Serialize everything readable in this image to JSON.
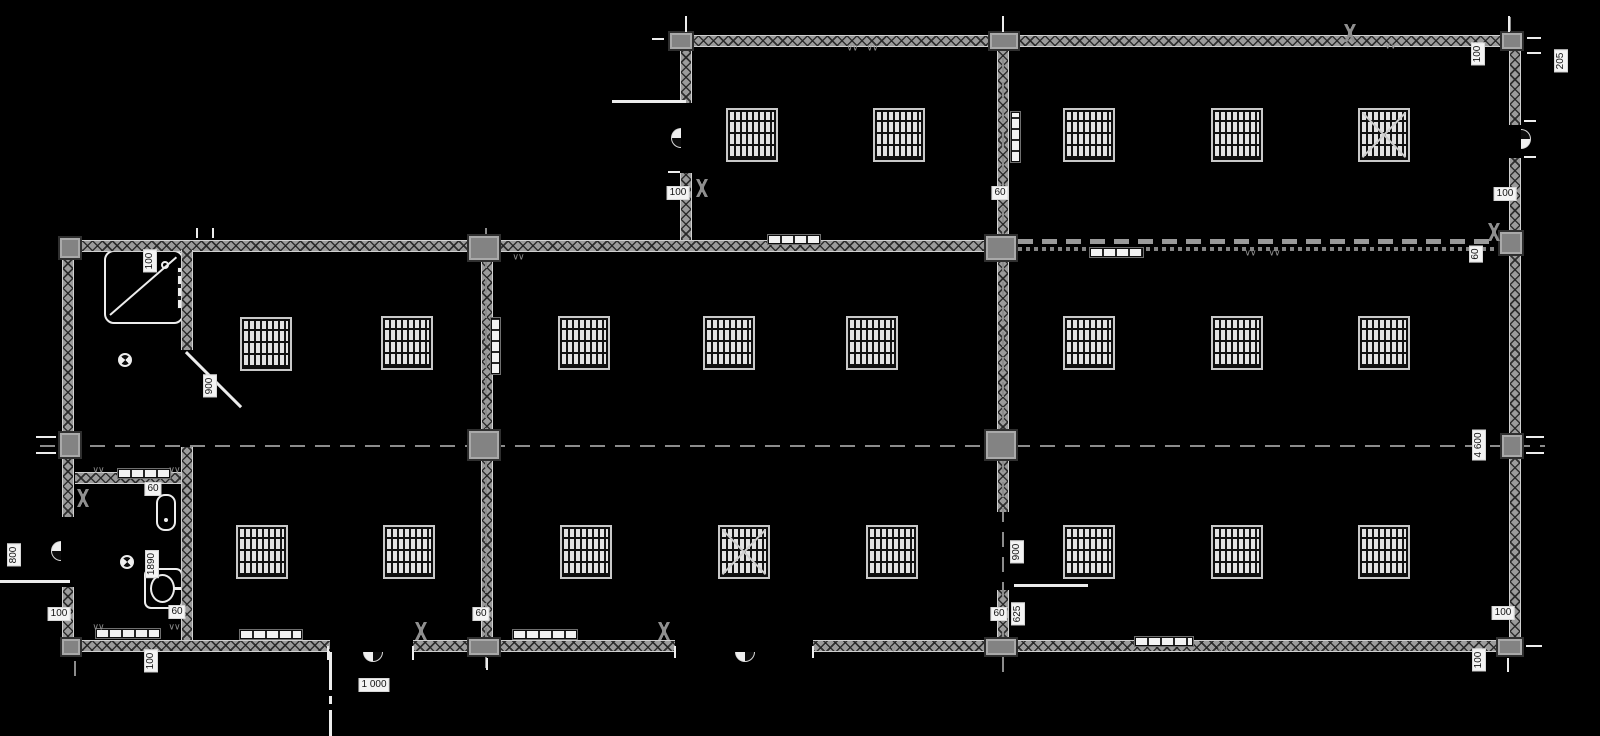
{
  "drawing": {
    "type": "floor_plan",
    "background": "#000000",
    "wall_color": "#9b9b9b",
    "hatch_color": "#2f2f2f",
    "annotation_color": "#f4f4f4",
    "glyphs": {
      "squiggle": "∨∨"
    },
    "labels": [
      {
        "t": "100",
        "x": 678,
        "y": 193,
        "r": 0
      },
      {
        "t": "60",
        "x": 1000,
        "y": 193,
        "r": 0
      },
      {
        "t": "100",
        "x": 1505,
        "y": 194,
        "r": 0
      },
      {
        "t": "100",
        "x": 1478,
        "y": 54,
        "r": 90
      },
      {
        "t": "205",
        "x": 1561,
        "y": 61,
        "r": 90
      },
      {
        "t": "100",
        "x": 150,
        "y": 261,
        "r": 90
      },
      {
        "t": "900",
        "x": 210,
        "y": 386,
        "r": 90
      },
      {
        "t": "800",
        "x": 14,
        "y": 555,
        "r": 90
      },
      {
        "t": "100",
        "x": 59,
        "y": 614,
        "r": 0
      },
      {
        "t": "60",
        "x": 153,
        "y": 489,
        "r": 0
      },
      {
        "t": "1890",
        "x": 152,
        "y": 564,
        "r": 90
      },
      {
        "t": "60",
        "x": 177,
        "y": 612,
        "r": 0
      },
      {
        "t": "100",
        "x": 151,
        "y": 661,
        "r": 90
      },
      {
        "t": "1 000",
        "x": 374,
        "y": 685,
        "r": 0
      },
      {
        "t": "60",
        "x": 481,
        "y": 614,
        "r": 0
      },
      {
        "t": "900",
        "x": 1017,
        "y": 552,
        "r": 90
      },
      {
        "t": "60",
        "x": 999,
        "y": 614,
        "r": 0
      },
      {
        "t": "625",
        "x": 1018,
        "y": 614,
        "r": 90
      },
      {
        "t": "60",
        "x": 1476,
        "y": 254,
        "r": 90
      },
      {
        "t": "4 600",
        "x": 1479,
        "y": 445,
        "r": 90
      },
      {
        "t": "100",
        "x": 1503,
        "y": 613,
        "r": 0
      },
      {
        "t": "100",
        "x": 1479,
        "y": 660,
        "r": 90
      }
    ],
    "walls_h": [
      [
        678,
        35,
        843
      ],
      [
        62,
        240,
        932
      ],
      [
        75,
        472,
        111
      ],
      [
        62,
        640,
        268
      ],
      [
        413,
        640,
        262
      ],
      [
        813,
        640,
        708
      ]
    ],
    "walls_dashed": [
      [
        994,
        239,
        506
      ]
    ],
    "walls_v": [
      [
        62,
        240,
        277
      ],
      [
        62,
        587,
        65
      ],
      [
        680,
        35,
        68
      ],
      [
        680,
        173,
        67
      ],
      [
        997,
        47,
        193
      ],
      [
        1509,
        47,
        78
      ],
      [
        1509,
        158,
        494
      ],
      [
        481,
        252,
        388
      ],
      [
        997,
        252,
        181
      ],
      [
        997,
        459,
        53
      ],
      [
        997,
        590,
        50
      ],
      [
        181,
        447,
        193
      ],
      [
        181,
        250,
        100
      ]
    ],
    "columns": [
      [
        668,
        31,
        26,
        20
      ],
      [
        988,
        31,
        32,
        20
      ],
      [
        1500,
        31,
        24,
        20
      ],
      [
        58,
        236,
        24,
        24
      ],
      [
        467,
        234,
        34,
        28
      ],
      [
        984,
        234,
        34,
        28
      ],
      [
        1498,
        230,
        26,
        26
      ],
      [
        58,
        431,
        24,
        28
      ],
      [
        467,
        429,
        34,
        32
      ],
      [
        984,
        429,
        34,
        32
      ],
      [
        1500,
        433,
        24,
        26
      ],
      [
        60,
        637,
        22,
        20
      ],
      [
        467,
        637,
        34,
        20
      ],
      [
        984,
        637,
        34,
        20
      ],
      [
        1496,
        637,
        28,
        20
      ]
    ],
    "axes_h": [
      [
        40,
        445,
        1505
      ]
    ],
    "axes_v": [
      [
        485,
        228,
        440
      ],
      [
        1002,
        18,
        654
      ],
      [
        685,
        14,
        20
      ],
      [
        1509,
        14,
        18
      ],
      [
        74,
        652,
        24
      ]
    ],
    "windows": [
      {
        "x": 728,
        "y": 110,
        "c": 0
      },
      {
        "x": 875,
        "y": 110,
        "c": 0
      },
      {
        "x": 1065,
        "y": 110,
        "c": 0
      },
      {
        "x": 1213,
        "y": 110,
        "c": 0
      },
      {
        "x": 1360,
        "y": 110,
        "c": 1
      },
      {
        "x": 242,
        "y": 319,
        "c": 0
      },
      {
        "x": 383,
        "y": 318,
        "c": 0
      },
      {
        "x": 560,
        "y": 318,
        "c": 0
      },
      {
        "x": 705,
        "y": 318,
        "c": 0
      },
      {
        "x": 848,
        "y": 318,
        "c": 0
      },
      {
        "x": 1065,
        "y": 318,
        "c": 0
      },
      {
        "x": 1213,
        "y": 318,
        "c": 0
      },
      {
        "x": 1360,
        "y": 318,
        "c": 0
      },
      {
        "x": 238,
        "y": 527,
        "c": 0
      },
      {
        "x": 385,
        "y": 527,
        "c": 0
      },
      {
        "x": 562,
        "y": 527,
        "c": 0
      },
      {
        "x": 720,
        "y": 527,
        "c": 1
      },
      {
        "x": 868,
        "y": 527,
        "c": 0
      },
      {
        "x": 1065,
        "y": 527,
        "c": 0
      },
      {
        "x": 1213,
        "y": 527,
        "c": 0
      },
      {
        "x": 1360,
        "y": 527,
        "c": 0
      }
    ],
    "grilles_h": [
      [
        768,
        235,
        52
      ],
      [
        1090,
        248,
        53
      ],
      [
        118,
        469,
        52
      ],
      [
        96,
        629,
        64
      ],
      [
        240,
        630,
        62
      ],
      [
        513,
        630,
        64
      ],
      [
        1135,
        637,
        58
      ]
    ],
    "grilles_v": [
      [
        1011,
        112,
        50
      ],
      [
        491,
        318,
        56
      ]
    ],
    "door_leaves": [
      [
        612,
        100,
        74,
        3,
        0
      ],
      [
        0,
        580,
        70,
        3,
        0
      ],
      [
        1014,
        584,
        74,
        3,
        0
      ],
      [
        187,
        351,
        78,
        3,
        45
      ]
    ],
    "path_segments": [
      [
        329,
        652,
        3,
        38
      ],
      [
        329,
        696,
        3,
        8
      ],
      [
        329,
        710,
        3,
        26
      ]
    ],
    "door_arcs": [
      {
        "x": 671,
        "y": 128,
        "dir": "left"
      },
      {
        "x": 1521,
        "y": 129,
        "dir": "right"
      },
      {
        "x": 51,
        "y": 541,
        "dir": "left"
      },
      {
        "x": 363,
        "y": 652,
        "dir": "down"
      },
      {
        "x": 735,
        "y": 652,
        "dir": "down"
      }
    ],
    "swing_marks": [
      [
        702,
        188
      ],
      [
        83,
        498
      ],
      [
        421,
        631
      ],
      [
        664,
        631
      ],
      [
        1494,
        232
      ],
      [
        1350,
        33
      ]
    ],
    "squiggles": [
      [
        852,
        48
      ],
      [
        872,
        48
      ],
      [
        1390,
        46
      ],
      [
        518,
        257
      ],
      [
        1250,
        253
      ],
      [
        1274,
        253
      ],
      [
        890,
        649
      ],
      [
        1222,
        649
      ],
      [
        98,
        470
      ],
      [
        174,
        470
      ],
      [
        98,
        627
      ],
      [
        174,
        627
      ]
    ],
    "drains": [
      [
        118,
        353
      ],
      [
        120,
        555
      ]
    ],
    "ticks": [
      [
        652,
        38,
        12,
        2
      ],
      [
        685,
        16,
        2,
        16
      ],
      [
        1002,
        16,
        2,
        16
      ],
      [
        1508,
        16,
        2,
        16
      ],
      [
        1527,
        37,
        14,
        2
      ],
      [
        1527,
        52,
        14,
        2
      ],
      [
        196,
        228,
        2,
        10
      ],
      [
        212,
        228,
        2,
        10
      ],
      [
        668,
        100,
        12,
        2
      ],
      [
        668,
        171,
        12,
        2
      ],
      [
        1524,
        120,
        12,
        2
      ],
      [
        1524,
        156,
        12,
        2
      ],
      [
        36,
        436,
        20,
        2
      ],
      [
        36,
        452,
        20,
        2
      ],
      [
        1526,
        436,
        18,
        2
      ],
      [
        1526,
        452,
        18,
        2
      ],
      [
        486,
        658,
        2,
        12
      ],
      [
        1526,
        645,
        16,
        2
      ],
      [
        1507,
        658,
        2,
        14
      ],
      [
        327,
        646,
        2,
        14
      ],
      [
        412,
        646,
        2,
        14
      ],
      [
        674,
        646,
        2,
        12
      ],
      [
        812,
        646,
        2,
        12
      ]
    ]
  }
}
